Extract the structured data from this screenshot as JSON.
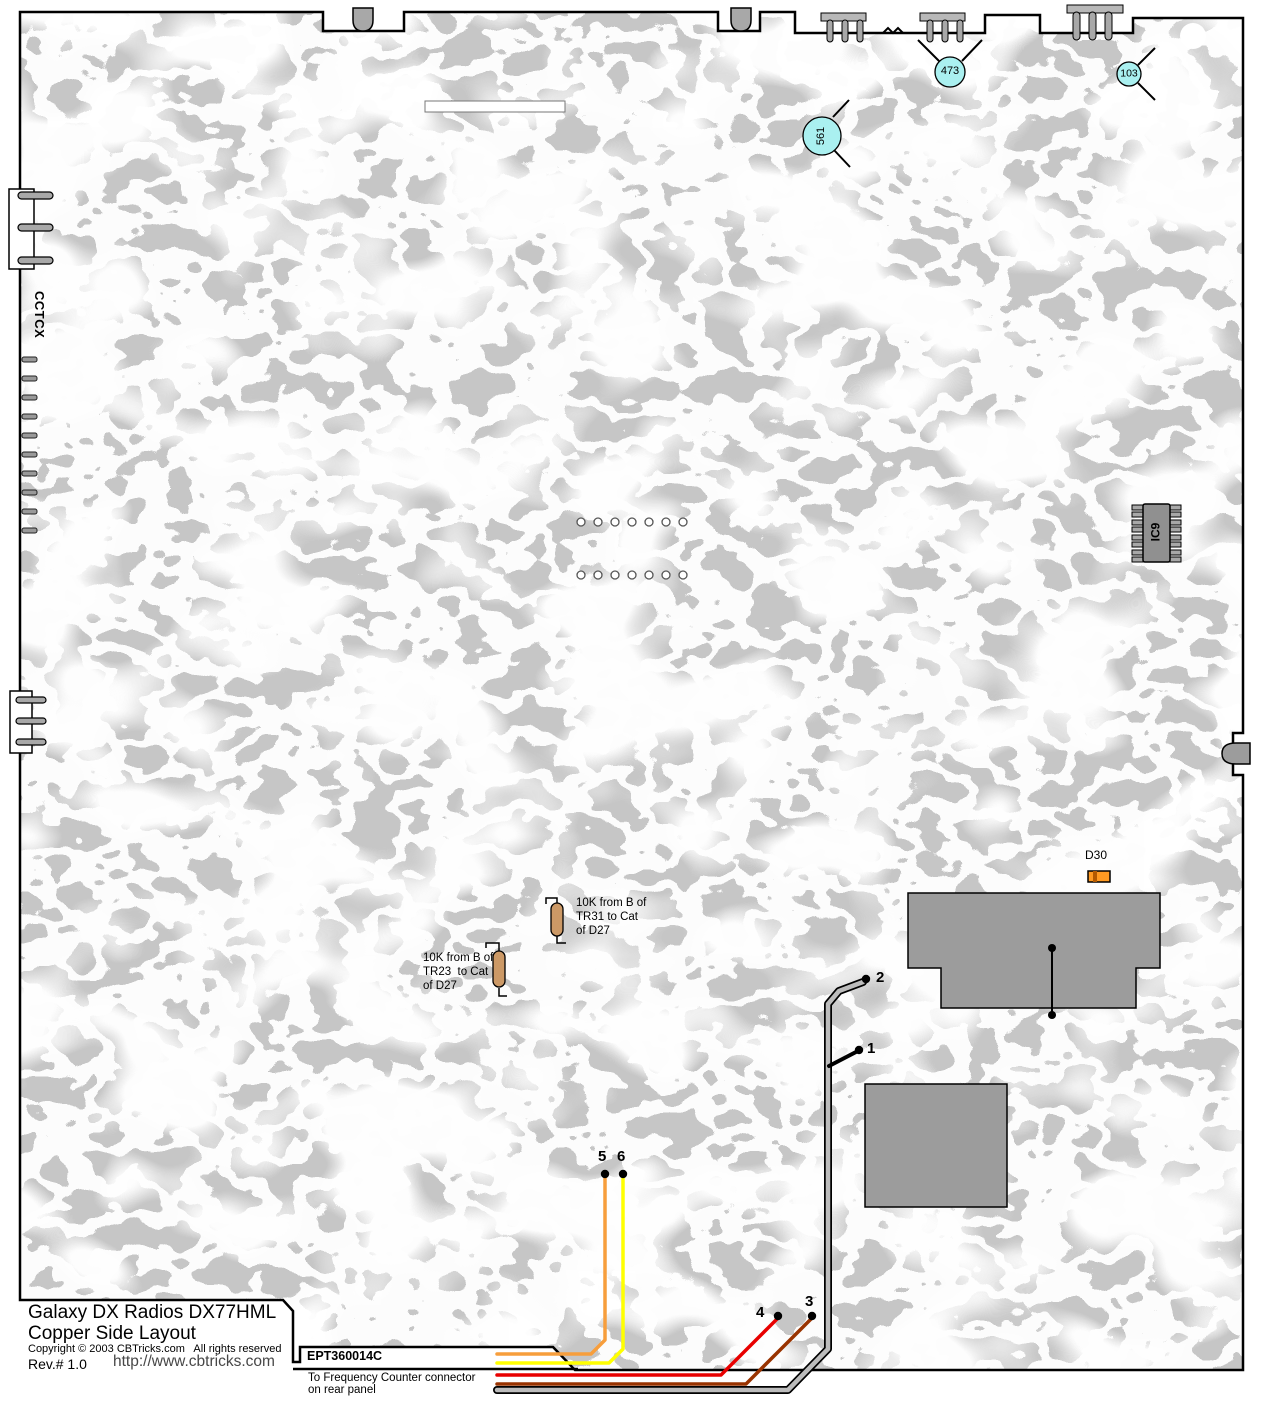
{
  "title_block": {
    "line1": "Galaxy DX Radios DX77HML",
    "line2": "Copper Side Layout",
    "copyright": "Copyright © 2003 CBTricks.com   All rights reserved",
    "rev": "Rev.# 1.0",
    "url": "http://www.cbtricks.com"
  },
  "bottom_strip": {
    "part_number": "EPT360014C",
    "freq_line1": "To Frequency Counter connector",
    "freq_line2": "on rear panel"
  },
  "edge_labels": {
    "left_connector": "CCTCX"
  },
  "components": {
    "trimmer_561": "561",
    "trimmer_473": "473",
    "trimmer_103": "103",
    "ic9": "IC9",
    "d30": "D30"
  },
  "notes": {
    "tr31": [
      "10K from B of",
      "TR31 to Cat",
      "of D27"
    ],
    "tr23": [
      "10K from B of",
      "TR23  to Cat",
      "of D27"
    ]
  },
  "wire_points": {
    "p1": "1",
    "p2": "2",
    "p3": "3",
    "p4": "4",
    "p5": "5",
    "p6": "6"
  },
  "colors": {
    "copper": "#c6c6c6",
    "trace_white": "#ffffff",
    "component_gray": "#9c9c9c",
    "pin_gray": "#a8a8a8",
    "cable_gray": "#bcbcbc",
    "trimmer_cyan": "#aaf0f0",
    "resistor_tan": "#cc9966",
    "d30_orange": "#ff9a22",
    "d30_band": "#b35900",
    "wire_orange": "#f79e3c",
    "wire_yellow": "#ffff00",
    "wire_red": "#e80000",
    "wire_brown": "#993300",
    "outline_black": "#000000"
  }
}
